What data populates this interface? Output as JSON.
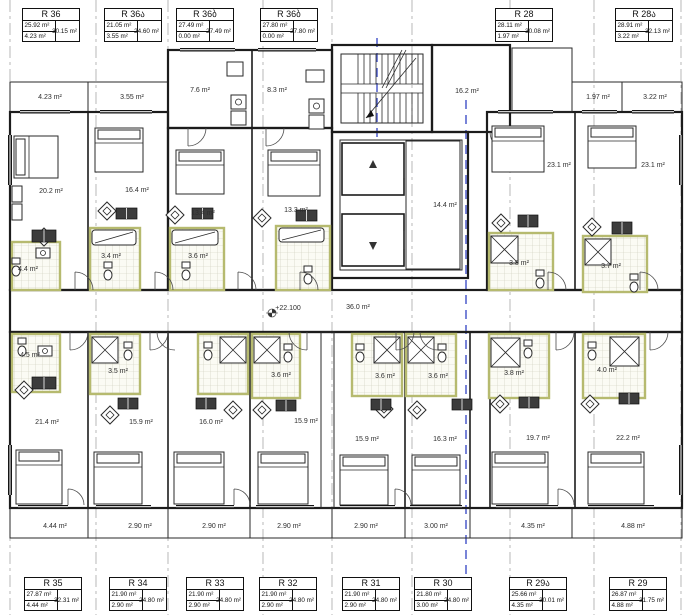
{
  "drawing": {
    "type": "architectural-floor-plan",
    "colors": {
      "section_line": "#4050c8",
      "core_fill": "#d4d4d4",
      "balcony_hatch": "#adadad"
    },
    "labels": [
      {
        "text": "4.23 m²",
        "x": 50,
        "y": 99
      },
      {
        "text": "3.55 m²",
        "x": 132,
        "y": 99
      },
      {
        "text": "7.6 m²",
        "x": 200,
        "y": 92
      },
      {
        "text": "8.3 m²",
        "x": 277,
        "y": 92
      },
      {
        "text": "16.2 m²",
        "x": 467,
        "y": 93
      },
      {
        "text": "1.97 m²",
        "x": 598,
        "y": 99
      },
      {
        "text": "3.22 m²",
        "x": 655,
        "y": 99
      },
      {
        "text": "20.2 m²",
        "x": 51,
        "y": 193
      },
      {
        "text": "16.4 m²",
        "x": 137,
        "y": 192
      },
      {
        "text": "13.4 m²",
        "x": 203,
        "y": 215
      },
      {
        "text": "13.3 m²",
        "x": 296,
        "y": 212
      },
      {
        "text": "14.4 m²",
        "x": 445,
        "y": 207
      },
      {
        "text": "23.1 m²",
        "x": 559,
        "y": 167
      },
      {
        "text": "23.1 m²",
        "x": 653,
        "y": 167
      },
      {
        "text": "4.4 m²",
        "x": 28,
        "y": 271,
        "size": 6
      },
      {
        "text": "3.4 m²",
        "x": 111,
        "y": 258,
        "size": 6
      },
      {
        "text": "3.6 m²",
        "x": 198,
        "y": 258,
        "size": 6
      },
      {
        "text": "3.8 m²",
        "x": 519,
        "y": 265,
        "size": 6
      },
      {
        "text": "3.7 m²",
        "x": 611,
        "y": 268,
        "size": 6
      },
      {
        "text": "+22.100",
        "x": 288,
        "y": 310,
        "size": 6.5,
        "color": "#8f8f8f"
      },
      {
        "text": "36.0 m²",
        "x": 358,
        "y": 309,
        "size": 6.5,
        "color": "#8f8f8f"
      },
      {
        "text": "4.5 m²",
        "x": 30,
        "y": 357,
        "size": 6
      },
      {
        "text": "3.5 m²",
        "x": 118,
        "y": 373,
        "size": 6
      },
      {
        "text": "3.6 m²",
        "x": 281,
        "y": 377,
        "size": 6
      },
      {
        "text": "3.6 m²",
        "x": 385,
        "y": 378,
        "size": 6
      },
      {
        "text": "3.6 m²",
        "x": 438,
        "y": 378,
        "size": 6
      },
      {
        "text": "3.8 m²",
        "x": 514,
        "y": 375,
        "size": 6
      },
      {
        "text": "4.0 m²",
        "x": 607,
        "y": 372,
        "size": 6
      },
      {
        "text": "21.4 m²",
        "x": 47,
        "y": 424
      },
      {
        "text": "15.9 m²",
        "x": 141,
        "y": 424
      },
      {
        "text": "16.0 m²",
        "x": 211,
        "y": 424
      },
      {
        "text": "15.9 m²",
        "x": 306,
        "y": 423
      },
      {
        "text": "15.9 m²",
        "x": 367,
        "y": 441
      },
      {
        "text": "16.3 m²",
        "x": 445,
        "y": 441
      },
      {
        "text": "19.7 m²",
        "x": 538,
        "y": 440
      },
      {
        "text": "22.2 m²",
        "x": 628,
        "y": 440
      },
      {
        "text": "4.44 m²",
        "x": 55,
        "y": 528
      },
      {
        "text": "2.90 m²",
        "x": 140,
        "y": 528
      },
      {
        "text": "2.90 m²",
        "x": 214,
        "y": 528
      },
      {
        "text": "2.90 m²",
        "x": 289,
        "y": 528
      },
      {
        "text": "2.90 m²",
        "x": 366,
        "y": 528
      },
      {
        "text": "3.00 m²",
        "x": 436,
        "y": 528
      },
      {
        "text": "4.35 m²",
        "x": 533,
        "y": 528
      },
      {
        "text": "4.88 m²",
        "x": 633,
        "y": 528
      }
    ],
    "title_blocks": {
      "top": [
        {
          "name": "R 36",
          "inner": "25.92 m²",
          "balcony": "4.23 m²",
          "total": "30.15 m²",
          "x": 22
        },
        {
          "name": "R 36ა",
          "inner": "21.05 m²",
          "balcony": "3.55 m²",
          "total": "24.60 m²",
          "x": 104
        },
        {
          "name": "R 36ბ",
          "inner": "27.49 m²",
          "balcony": "0.00 m²",
          "total": "27.49 m²",
          "x": 176
        },
        {
          "name": "R 36ბ",
          "inner": "27.80 m²",
          "balcony": "0.00 m²",
          "total": "27.80 m²",
          "x": 260
        },
        {
          "name": "R 28",
          "inner": "28.11 m²",
          "balcony": "1.97 m²",
          "total": "30.08 m²",
          "x": 495
        },
        {
          "name": "R 28ა",
          "inner": "28.91 m²",
          "balcony": "3.22 m²",
          "total": "32.13 m²",
          "x": 615
        }
      ],
      "bottom": [
        {
          "name": "R 35",
          "inner": "27.87 m²",
          "balcony": "4.44 m²",
          "total": "32.31 m²",
          "x": 24
        },
        {
          "name": "R 34",
          "inner": "21.90 m²",
          "balcony": "2.90 m²",
          "total": "24.80 m²",
          "x": 109
        },
        {
          "name": "R 33",
          "inner": "21.90 m²",
          "balcony": "2.90 m²",
          "total": "24.80 m²",
          "x": 186
        },
        {
          "name": "R 32",
          "inner": "21.90 m²",
          "balcony": "2.90 m²",
          "total": "24.80 m²",
          "x": 259
        },
        {
          "name": "R 31",
          "inner": "21.90 m²",
          "balcony": "2.90 m²",
          "total": "24.80 m²",
          "x": 342
        },
        {
          "name": "R 30",
          "inner": "21.80 m²",
          "balcony": "3.00 m²",
          "total": "24.80 m²",
          "x": 414
        },
        {
          "name": "R 29ა",
          "inner": "25.66 m²",
          "balcony": "4.35 m²",
          "total": "30.01 m²",
          "x": 509
        },
        {
          "name": "R 29",
          "inner": "26.87 m²",
          "balcony": "4.88 m²",
          "total": "31.75 m²",
          "x": 609
        }
      ]
    }
  }
}
